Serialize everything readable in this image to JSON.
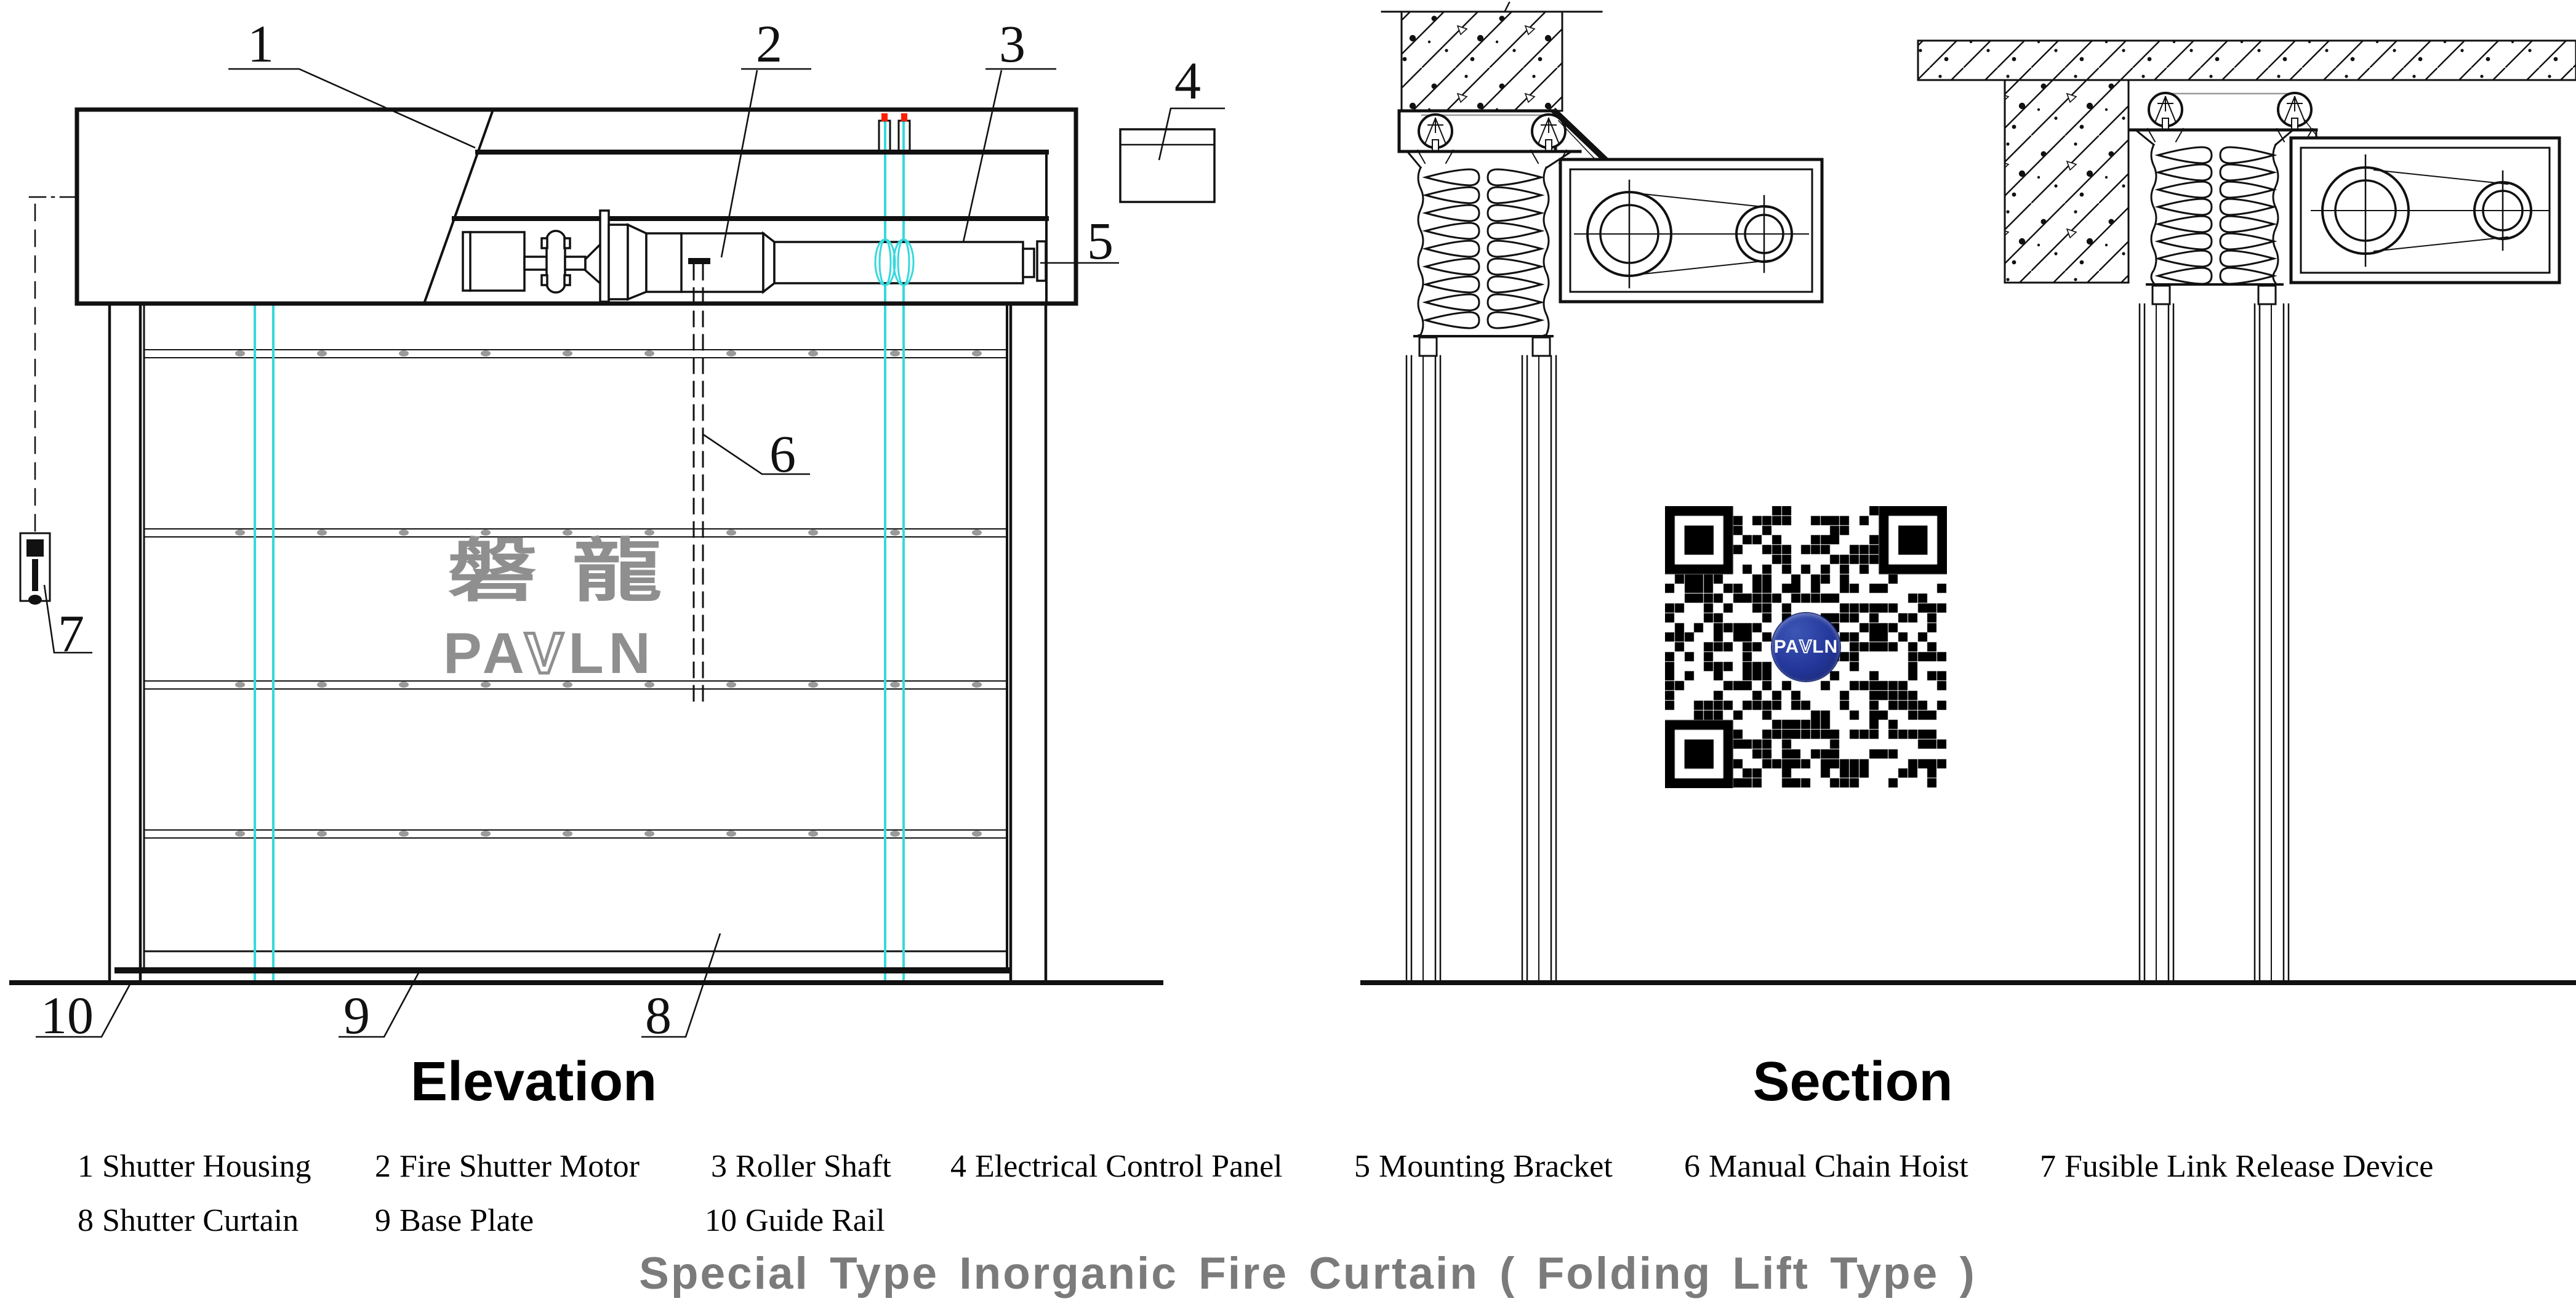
{
  "drawing": {
    "views": {
      "elevation_label": "Elevation",
      "section_label": "Section"
    },
    "callouts": [
      "1",
      "2",
      "3",
      "4",
      "5",
      "6",
      "7",
      "8",
      "9",
      "10"
    ],
    "legend": {
      "row1": [
        {
          "num": "1",
          "label": "Shutter Housing"
        },
        {
          "num": "2",
          "label": "Fire Shutter Motor"
        },
        {
          "num": "3",
          "label": "Roller Shaft"
        },
        {
          "num": "4",
          "label": "Electrical Control Panel"
        },
        {
          "num": "5",
          "label": "Mounting Bracket"
        },
        {
          "num": "6",
          "label": "Manual Chain Hoist"
        },
        {
          "num": "7",
          "label": "Fusible Link Release Device"
        }
      ],
      "row2": [
        {
          "num": "8",
          "label": "Shutter Curtain"
        },
        {
          "num": "9",
          "label": "Base Plate"
        },
        {
          "num": "10",
          "label": "Guide Rail"
        }
      ]
    },
    "title": "Special Type Inorganic Fire Curtain ( Folding Lift Type )",
    "watermark": {
      "cjk": "磐龍",
      "pa": "PA",
      "v": "V",
      "ln": "LN"
    },
    "qr_logo": {
      "pa": "PA",
      "v": "V",
      "ln": "LN"
    },
    "colors": {
      "line_black": "#111111",
      "accent_cyan": "#35d9dd",
      "accent_red": "#ff1d00",
      "title_gray": "#7b7b7b",
      "watermark_gray": "#8f8f8f",
      "rivet_gray": "#9a9a9a",
      "logo_blue": "#203a96"
    }
  }
}
